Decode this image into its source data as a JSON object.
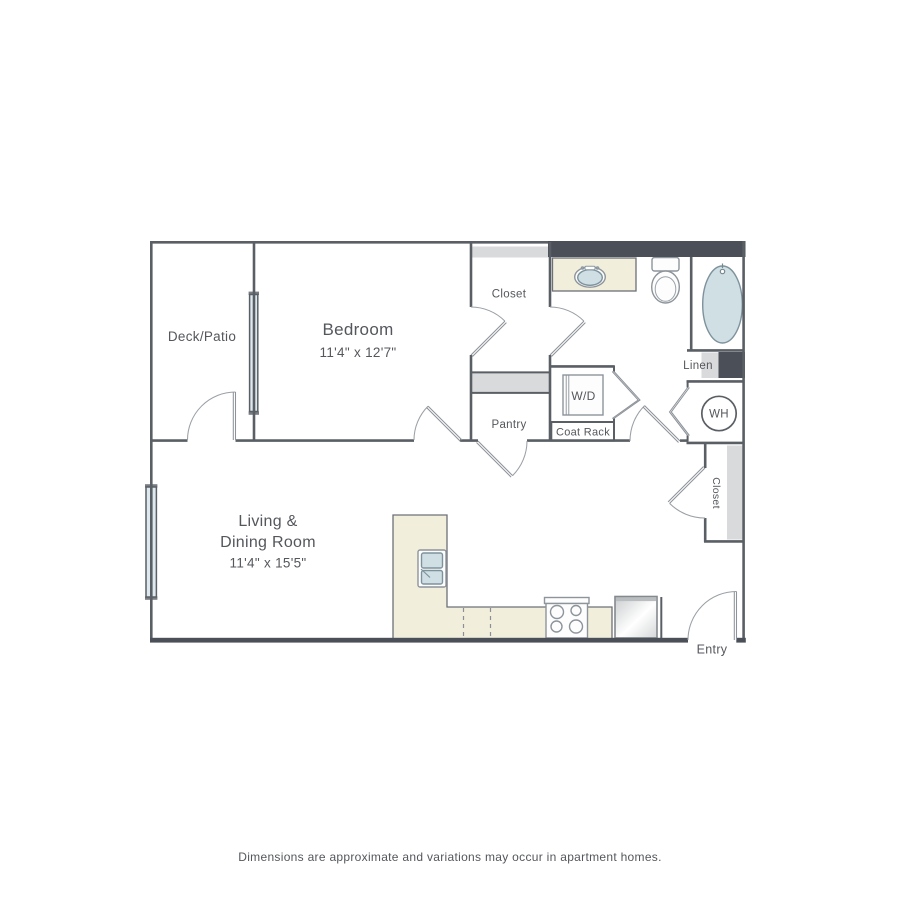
{
  "colors": {
    "wall_line": "#5a5f65",
    "wall_fill": "#4b5058",
    "shelf_gray": "#d9dadc",
    "counter_cream": "#f2eedc",
    "fixture_blue": "#cfdfe4",
    "window_blue": "#dde9ee",
    "label_text": "#54575c",
    "door_line": "#8d9399",
    "background": "#ffffff"
  },
  "plan": {
    "rooms": {
      "deck_patio": {
        "label": "Deck/Patio"
      },
      "bedroom": {
        "label": "Bedroom",
        "dimensions": "11'4\" x 12'7\""
      },
      "living_dining": {
        "line1": "Living &",
        "line2": "Dining Room",
        "dimensions": "11'4\" x 15'5\""
      },
      "bedroom_closet": {
        "label": "Closet"
      },
      "pantry": {
        "label": "Pantry"
      },
      "entry_closet": {
        "label": "Closet"
      },
      "entry": {
        "label": "Entry"
      }
    },
    "fixtures": {
      "washer_dryer": {
        "label": "W/D"
      },
      "coat_rack": {
        "label": "Coat Rack"
      },
      "linen": {
        "label": "Linen"
      },
      "water_heater": {
        "label": "WH"
      }
    }
  },
  "footer": {
    "disclaimer": "Dimensions are approximate and variations may occur in apartment homes."
  }
}
